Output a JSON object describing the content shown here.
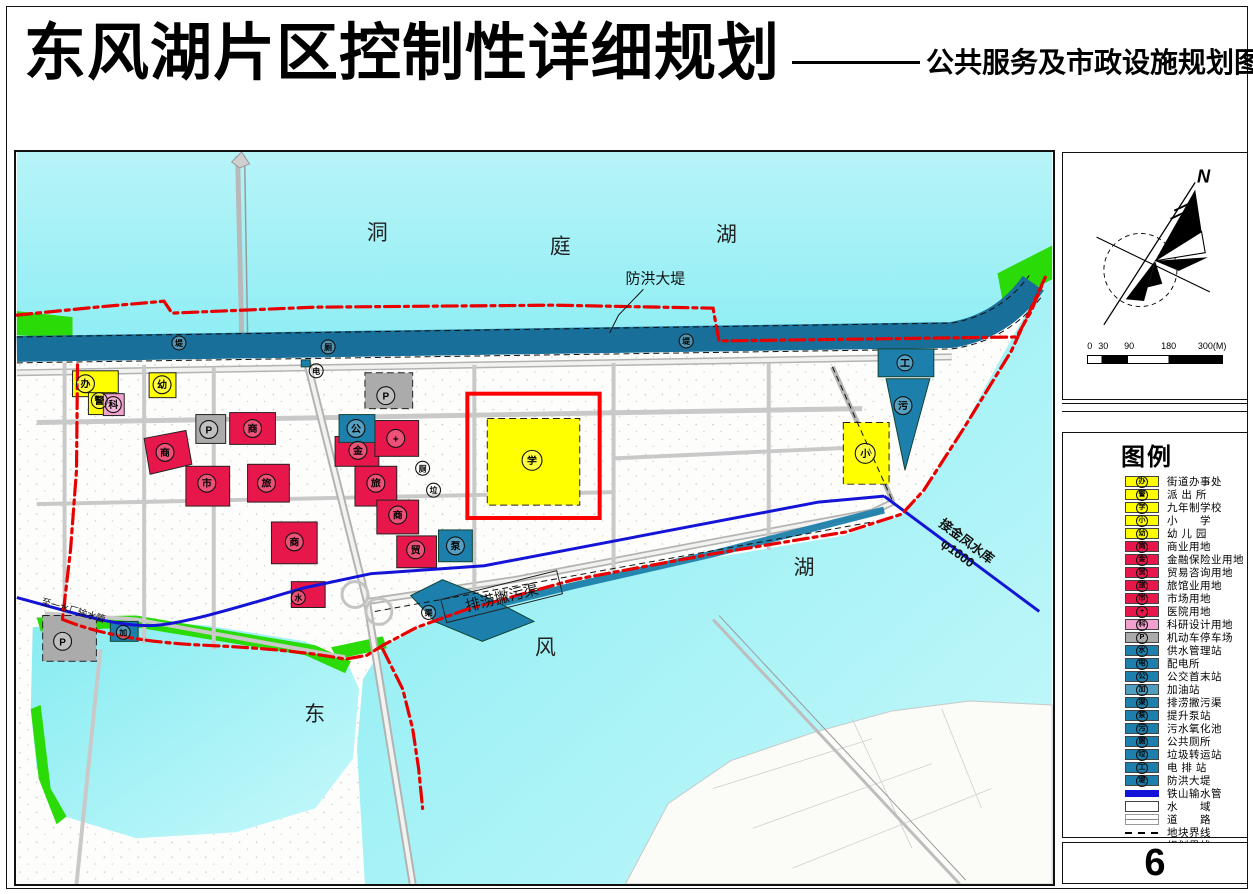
{
  "title": {
    "main": "东风湖片区控制性详细规划",
    "sub": "公共服务及市政设施规划图"
  },
  "page_number": "6",
  "compass": {
    "north_label": "N"
  },
  "scalebar": {
    "ticks": [
      "0",
      "30",
      "90",
      "180",
      "300(M)"
    ]
  },
  "colors": {
    "yellow": "#ffff00",
    "red": "#e8174b",
    "pink": "#f2a0cd",
    "gray": "#ababab",
    "blue": "#1d7fab",
    "blue-light": "#4f9ec0",
    "dike": "#186f99",
    "green": "#2bdb07",
    "pipe": "#1414d8",
    "boundary": "#e80000",
    "water-top": "#9ff0f5",
    "water-bottom": "#8deef2",
    "road": "#c9c9c9"
  },
  "map": {
    "lake_top": [
      "洞",
      "庭",
      "湖"
    ],
    "lake_bottom": [
      "东",
      "风",
      "湖"
    ],
    "annotations": {
      "dike": "防洪大堤",
      "channel": "排涝撇污渠",
      "reservoir_line1": "接金凤水库",
      "reservoir_line2": "φ1600",
      "waterplant": "至一水厂输水管"
    },
    "symbols": [
      {
        "name": "street-office",
        "glyph": "办"
      },
      {
        "name": "police-station",
        "glyph": "警"
      },
      {
        "name": "research-design",
        "glyph": "科"
      },
      {
        "name": "kindergarten",
        "glyph": "幼"
      },
      {
        "name": "parking",
        "glyph": "P"
      },
      {
        "name": "commercial",
        "glyph": "商"
      },
      {
        "name": "commercial",
        "glyph": "商"
      },
      {
        "name": "market",
        "glyph": "市"
      },
      {
        "name": "hotel",
        "glyph": "旅"
      },
      {
        "name": "commercial",
        "glyph": "商"
      },
      {
        "name": "parking",
        "glyph": "P"
      },
      {
        "name": "bus-terminal",
        "glyph": "公"
      },
      {
        "name": "finance-insurance",
        "glyph": "金"
      },
      {
        "name": "hospital",
        "glyph": "+"
      },
      {
        "name": "hotel",
        "glyph": "旅"
      },
      {
        "name": "public-toilet",
        "glyph": "厕"
      },
      {
        "name": "garbage-transfer",
        "glyph": "垃"
      },
      {
        "name": "commercial",
        "glyph": "商"
      },
      {
        "name": "trade-consult",
        "glyph": "贸"
      },
      {
        "name": "lift-pump-station",
        "glyph": "泵"
      },
      {
        "name": "nine-year-school",
        "glyph": "学"
      },
      {
        "name": "primary-school",
        "glyph": "小"
      },
      {
        "name": "sewage-oxidation",
        "glyph": "污"
      },
      {
        "name": "drainage-pump-station",
        "glyph": "工"
      },
      {
        "name": "flood-dike",
        "glyph": "堤"
      },
      {
        "name": "flood-dike",
        "glyph": "堤"
      },
      {
        "name": "public-toilet",
        "glyph": "厕"
      },
      {
        "name": "power-substation",
        "glyph": "电"
      },
      {
        "name": "parking",
        "glyph": "P"
      },
      {
        "name": "gas-station",
        "glyph": "加"
      },
      {
        "name": "water-supply-station",
        "glyph": "水"
      },
      {
        "name": "drain-channel",
        "glyph": "渠"
      }
    ]
  },
  "legend": {
    "title": "图例",
    "items": [
      {
        "glyph": "办",
        "label": "街道办事处",
        "type": "area",
        "color": "#ffff00"
      },
      {
        "glyph": "警",
        "label": "派 出 所",
        "type": "area",
        "color": "#ffff00"
      },
      {
        "glyph": "学",
        "label": "九年制学校",
        "type": "area",
        "color": "#ffff00"
      },
      {
        "glyph": "小",
        "label": "小　　学",
        "type": "area",
        "color": "#ffff00"
      },
      {
        "glyph": "幼",
        "label": "幼 儿 园",
        "type": "area",
        "color": "#ffff00"
      },
      {
        "glyph": "商",
        "label": "商业用地",
        "type": "area",
        "color": "#e8174b"
      },
      {
        "glyph": "金",
        "label": "金融保险业用地",
        "type": "area",
        "color": "#e8174b"
      },
      {
        "glyph": "贸",
        "label": "贸易咨询用地",
        "type": "area",
        "color": "#e8174b"
      },
      {
        "glyph": "旅",
        "label": "旅馆业用地",
        "type": "area",
        "color": "#e8174b"
      },
      {
        "glyph": "市",
        "label": "市场用地",
        "type": "area",
        "color": "#e8174b"
      },
      {
        "glyph": "+",
        "label": "医院用地",
        "type": "area",
        "color": "#e8174b"
      },
      {
        "glyph": "科",
        "label": "科研设计用地",
        "type": "area",
        "color": "#f2a0cd"
      },
      {
        "glyph": "P",
        "label": "机动车停车场",
        "type": "area",
        "color": "#ababab"
      },
      {
        "glyph": "水",
        "label": "供水管理站",
        "type": "area",
        "color": "#1d7fab"
      },
      {
        "glyph": "电",
        "label": "配电所",
        "type": "area",
        "color": "#1d7fab"
      },
      {
        "glyph": "公",
        "label": "公交首末站",
        "type": "area",
        "color": "#1d7fab"
      },
      {
        "glyph": "加",
        "label": "加油站",
        "type": "area",
        "color": "#4f9ec0"
      },
      {
        "glyph": "渠",
        "label": "排涝撇污渠",
        "type": "area",
        "color": "#1d7fab"
      },
      {
        "glyph": "泵",
        "label": "提升泵站",
        "type": "area",
        "color": "#1d7fab"
      },
      {
        "glyph": "污",
        "label": "污水氧化池",
        "type": "area",
        "color": "#1d7fab"
      },
      {
        "glyph": "厕",
        "label": "公共厕所",
        "type": "area",
        "color": "#1d7fab"
      },
      {
        "glyph": "垃",
        "label": "垃圾转运站",
        "type": "area",
        "color": "#1d7fab"
      },
      {
        "glyph": "工",
        "label": "电 排 站",
        "type": "area",
        "color": "#1d7fab"
      },
      {
        "glyph": "堤",
        "label": "防洪大堤",
        "type": "area",
        "color": "#1d7fab"
      },
      {
        "glyph": "",
        "label": "铁山输水管",
        "type": "thickline",
        "color": "#1414d8"
      },
      {
        "glyph": "",
        "label": "水　　域",
        "type": "waterbox",
        "color": "#ffffff"
      },
      {
        "glyph": "",
        "label": "道　　路",
        "type": "road",
        "color": "#888888"
      },
      {
        "glyph": "",
        "label": "地块界线",
        "type": "dashblack",
        "color": "#000000"
      },
      {
        "glyph": "",
        "label": "规划界线",
        "type": "dashdotred",
        "color": "#e80000"
      }
    ]
  }
}
